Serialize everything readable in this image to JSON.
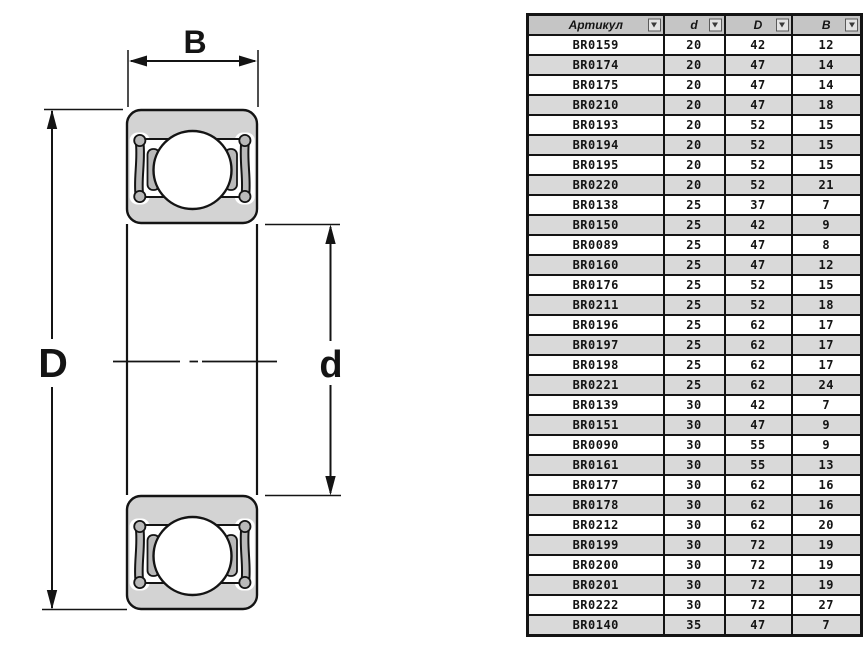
{
  "diagram": {
    "labels": {
      "width": "B",
      "outer_diameter": "D",
      "bore_diameter": "d"
    },
    "colors": {
      "ring_gray": "#d3d3d3",
      "seal_gray": "#b9b9b9",
      "line": "#141414"
    }
  },
  "table": {
    "headers": [
      "Артикул",
      "d",
      "D",
      "B"
    ],
    "filter_icon": "chevron-down",
    "rows": [
      [
        "BR0159",
        "20",
        "42",
        "12"
      ],
      [
        "BR0174",
        "20",
        "47",
        "14"
      ],
      [
        "BR0175",
        "20",
        "47",
        "14"
      ],
      [
        "BR0210",
        "20",
        "47",
        "18"
      ],
      [
        "BR0193",
        "20",
        "52",
        "15"
      ],
      [
        "BR0194",
        "20",
        "52",
        "15"
      ],
      [
        "BR0195",
        "20",
        "52",
        "15"
      ],
      [
        "BR0220",
        "20",
        "52",
        "21"
      ],
      [
        "BR0138",
        "25",
        "37",
        "7"
      ],
      [
        "BR0150",
        "25",
        "42",
        "9"
      ],
      [
        "BR0089",
        "25",
        "47",
        "8"
      ],
      [
        "BR0160",
        "25",
        "47",
        "12"
      ],
      [
        "BR0176",
        "25",
        "52",
        "15"
      ],
      [
        "BR0211",
        "25",
        "52",
        "18"
      ],
      [
        "BR0196",
        "25",
        "62",
        "17"
      ],
      [
        "BR0197",
        "25",
        "62",
        "17"
      ],
      [
        "BR0198",
        "25",
        "62",
        "17"
      ],
      [
        "BR0221",
        "25",
        "62",
        "24"
      ],
      [
        "BR0139",
        "30",
        "42",
        "7"
      ],
      [
        "BR0151",
        "30",
        "47",
        "9"
      ],
      [
        "BR0090",
        "30",
        "55",
        "9"
      ],
      [
        "BR0161",
        "30",
        "55",
        "13"
      ],
      [
        "BR0177",
        "30",
        "62",
        "16"
      ],
      [
        "BR0178",
        "30",
        "62",
        "16"
      ],
      [
        "BR0212",
        "30",
        "62",
        "20"
      ],
      [
        "BR0199",
        "30",
        "72",
        "19"
      ],
      [
        "BR0200",
        "30",
        "72",
        "19"
      ],
      [
        "BR0201",
        "30",
        "72",
        "19"
      ],
      [
        "BR0222",
        "30",
        "72",
        "27"
      ],
      [
        "BR0140",
        "35",
        "47",
        "7"
      ]
    ]
  }
}
